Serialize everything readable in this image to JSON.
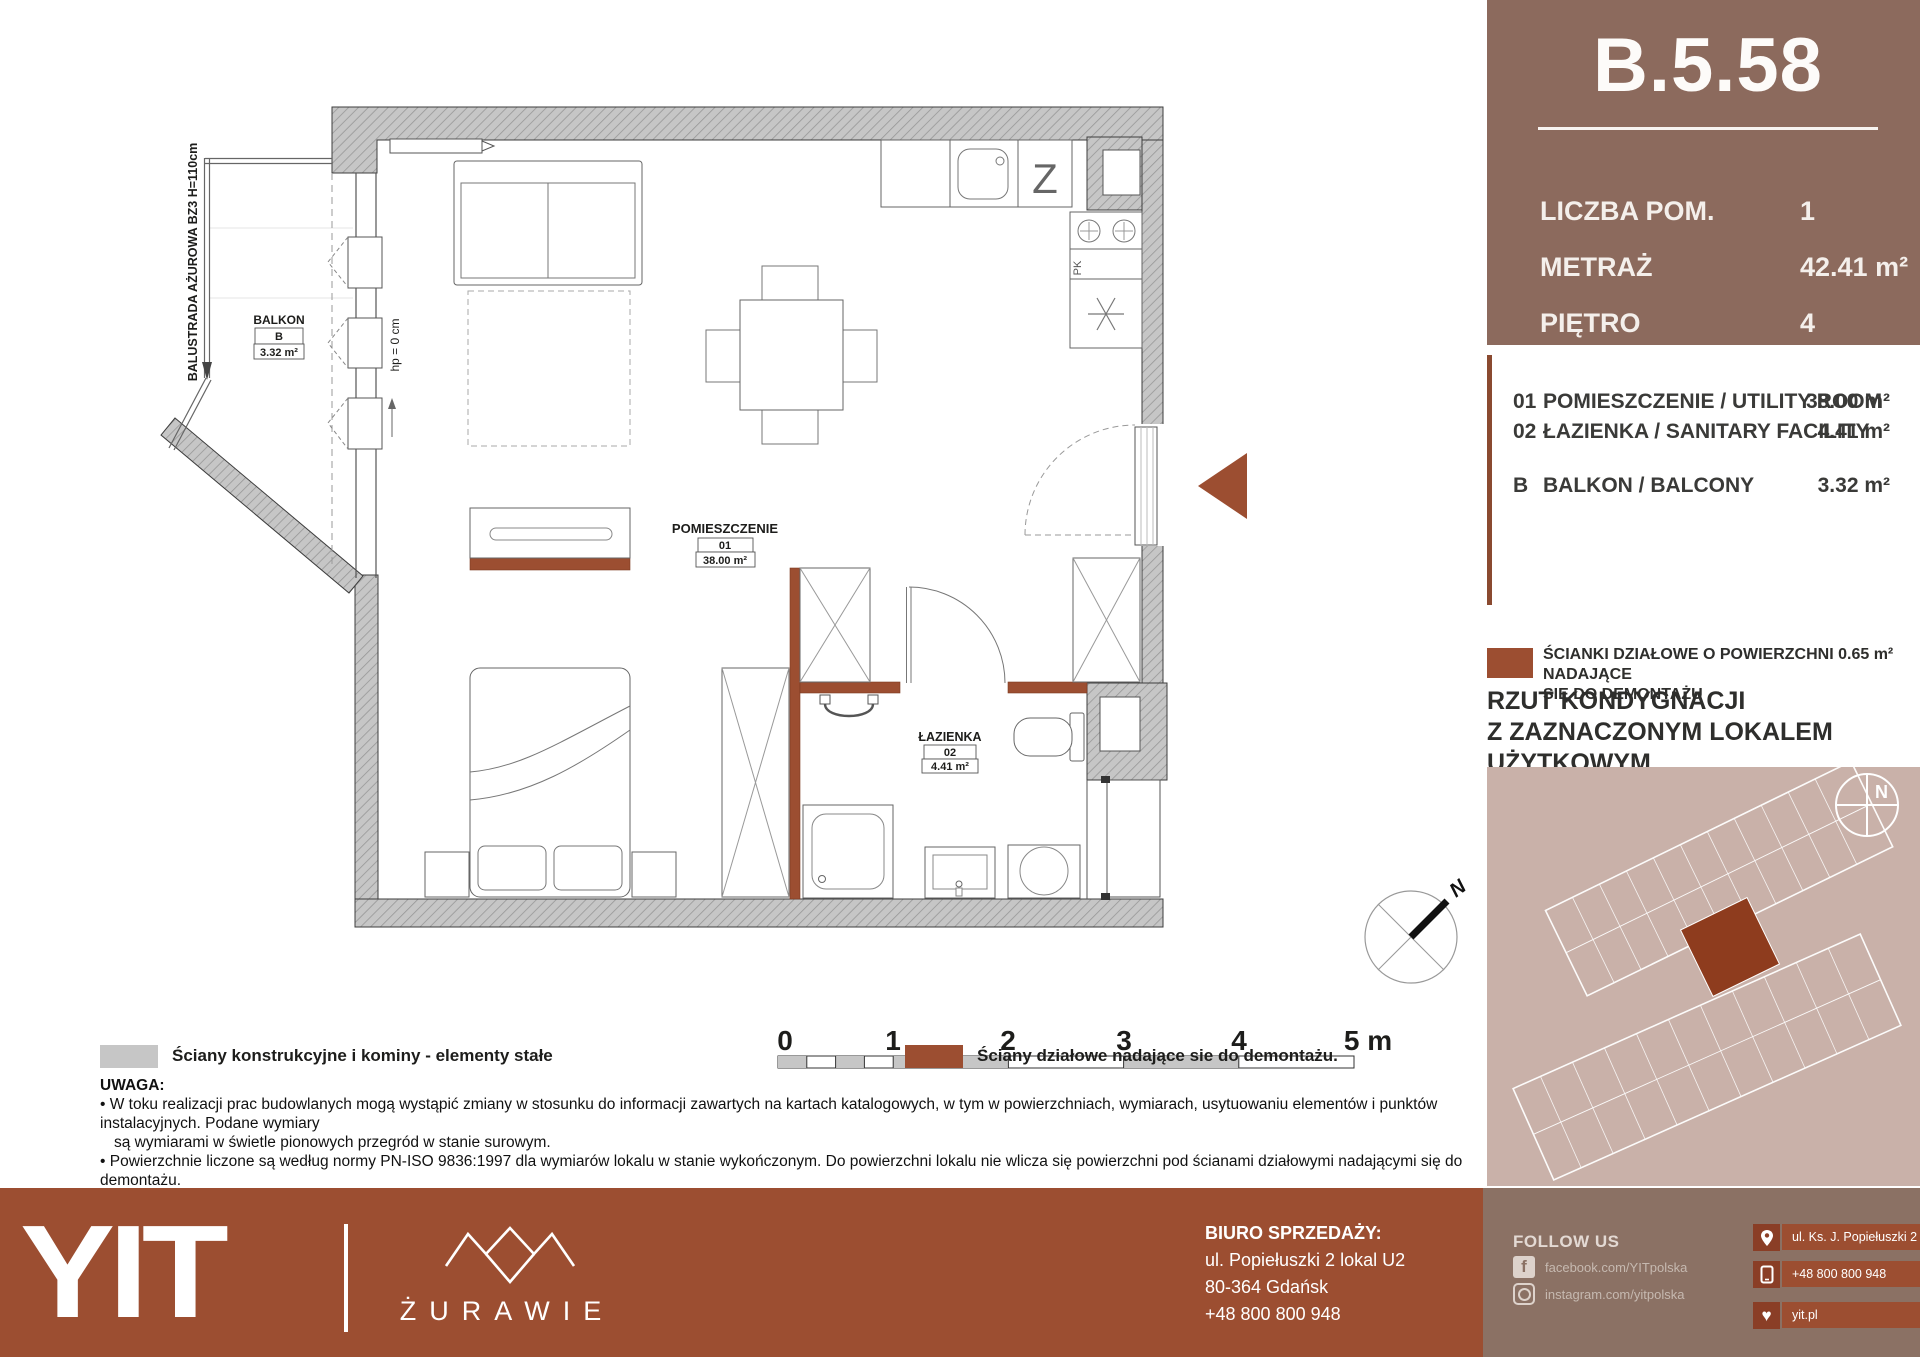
{
  "header": {
    "unit_id": "B.5.58",
    "rows": [
      {
        "label": "LICZBA POM.",
        "value": "1"
      },
      {
        "label": "METRAŻ",
        "value": "42.41 m²"
      },
      {
        "label": "PIĘTRO",
        "value": "4"
      }
    ]
  },
  "room_list": [
    {
      "no": "01",
      "name": "POMIESZCZENIE / UTILITY ROOM",
      "area": "38.00 m²"
    },
    {
      "no": "02",
      "name": "ŁAZIENKA / SANITARY FACILITY",
      "area": "4.41 m²"
    },
    {
      "no": "B",
      "name": "BALKON / BALCONY",
      "area": "3.32 m²"
    }
  ],
  "sidebar_legend": {
    "text": "ŚCIANKI DZIAŁOWE O POWIERZCHNI 0.65 m² NADAJĄCE\nSIĘ DO DEMONTAŻU"
  },
  "floor_note": {
    "text": "RZUT KONDYGNACJI\nZ ZAZNACZONYM LOKALEM UŻYTKOWYM"
  },
  "minimap": {
    "compass": "N"
  },
  "plan": {
    "balustrade": "BALUSTRADA AŻUROWA BZ3 H=110cm",
    "hp": "hp = 0 cm",
    "balcony": {
      "title": "BALKON",
      "code": "B",
      "area": "3.32 m²"
    },
    "room": {
      "title": "POMIESZCZENIE",
      "code": "01",
      "area": "38.00 m²"
    },
    "bath": {
      "title": "ŁAZIENKA",
      "code": "02",
      "area": "4.41 m²"
    },
    "kitchen_z": "Z",
    "kitchen_pk": "PK",
    "compass": "N"
  },
  "scalebar": {
    "labels": [
      "0",
      "1",
      "2",
      "3",
      "4",
      "5 m"
    ]
  },
  "legend": [
    {
      "label": "Ściany konstrukcyjne i kominy - elementy stałe"
    },
    {
      "label": "Ściany działowe nadające sie do demontażu."
    }
  ],
  "uwaga": {
    "title": "UWAGA:",
    "lines": [
      "• W toku realizacji prac budowlanych mogą wystąpić zmiany w stosunku do informacji zawartych na kartach katalogowych, w tym w powierzchniach, wymiarach, usytuowaniu elementów i punktów instalacyjnych. Podane wymiary",
      "są wymiarami w świetle pionowych przegród w stanie surowym.",
      "• Powierzchnie liczone są według normy PN-ISO 9836:1997 dla wymiarów lokalu w stanie wykończonym. Do powierzchni lokalu nie wlicza się powierzchni pod ścianami działowymi nadającymi się do demontażu.",
      "• Przedstawiona aranżacja, w tym drzwi wewnętrzne, umeblowanie, ceramika sanitarna, sprzęt AGD i RTV, ma charakter przykładowy i nie stanowi wyposażenia nabywanego lokalu. Pomiarów pod zakup mebli, urządzeń i",
      "wyposażenia należy dokonywać z natury, po zakończeniu realizacji."
    ]
  },
  "footer": {
    "brand": "YIT",
    "project": "ŻURAWIE",
    "office": {
      "title": "BIURO SPRZEDAŻY:",
      "lines": [
        "ul. Popiełuszki 2 lokal U2",
        "80-364 Gdańsk",
        "+48 800 800 948"
      ]
    },
    "follow": {
      "title": "FOLLOW US",
      "facebook": "facebook.com/YITpolska",
      "instagram": "instagram.com/yitpolska"
    },
    "contacts": [
      {
        "icon": "location-pin-icon",
        "text": "ul. Ks. J. Popiełuszki 2"
      },
      {
        "icon": "phone-icon",
        "text": "+48 800 800 948"
      },
      {
        "icon": "heart-icon",
        "text": "yit.pl"
      }
    ]
  },
  "colors": {
    "accent_brown": "#9c4e31",
    "sidebar_brown": "#8c6a5d",
    "minimap_bg": "#c9b1a9",
    "highlight_unit": "#8e3c1e",
    "footer_right": "#8b7164",
    "wall_gray": "#c3c3c3"
  }
}
